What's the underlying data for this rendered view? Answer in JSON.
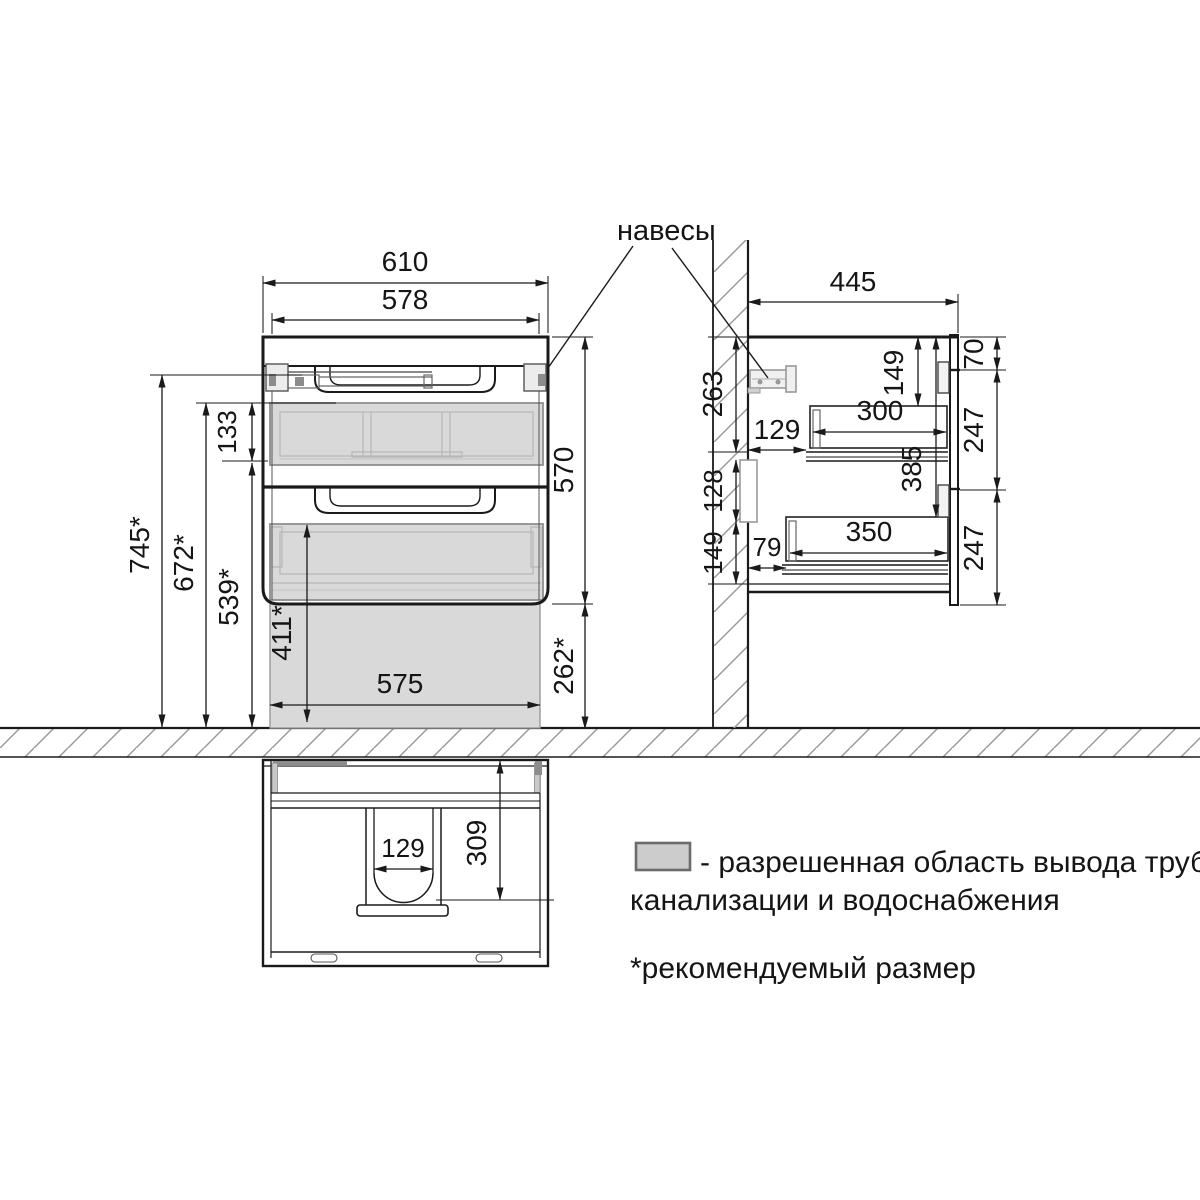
{
  "colors": {
    "line": "#1a1a1a",
    "hatch": "#9a9a9a",
    "allowed_zone_fill": "#d9d9d9",
    "hardware_fill": "#8c8c8c",
    "legend_swatch_fill": "#cccccc"
  },
  "callout": {
    "hangers_label": "навесы"
  },
  "front_view": {
    "dims": {
      "outer_width": "610",
      "inner_width": "578",
      "cabinet_height": "570",
      "mounting_height": "745*",
      "zone_top_height": "672*",
      "zone_band_height": "133",
      "zone_mid_height": "539*",
      "zone_inner_height": "411*",
      "floor_clearance": "262*",
      "zone_width": "575"
    }
  },
  "side_view": {
    "dims": {
      "depth": "445",
      "wall_offset_top": "263",
      "wall_niche_height": "128",
      "wall_offset_bottom": "149",
      "top_to_upper_drawer": "149",
      "top_to_lower_drawer": "385",
      "upper_drawer_depth": "300",
      "upper_drawer_wall_gap": "129",
      "lower_drawer_depth": "350",
      "lower_drawer_wall_gap": "79",
      "front_top_height": "70",
      "front_drawer1_height": "247",
      "front_drawer2_height": "247"
    }
  },
  "bottom_view": {
    "dims": {
      "cutout_width": "129",
      "cutout_depth": "309"
    }
  },
  "legend": {
    "zone_text_line1": "- разрешенная область вывода труб",
    "zone_text_line2": "канализации и водоснабжения",
    "footnote": "*рекомендуемый размер"
  }
}
